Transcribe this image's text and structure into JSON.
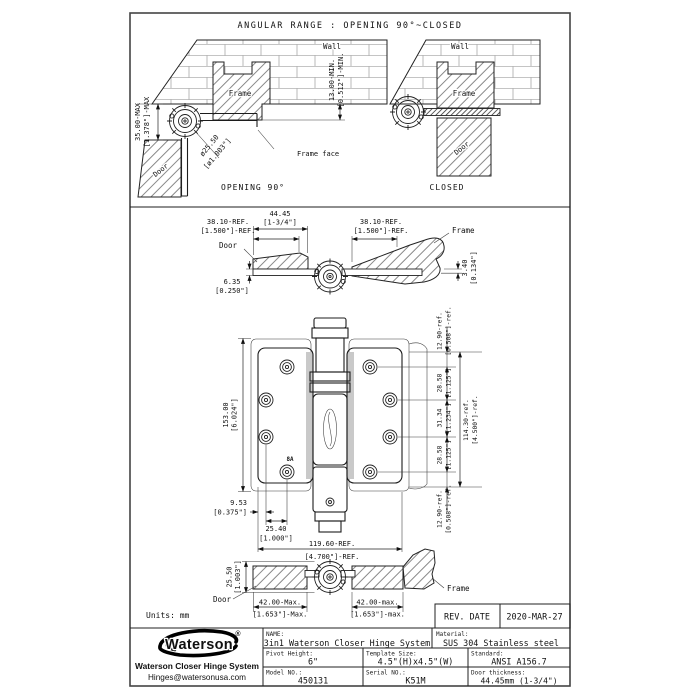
{
  "angular_panel": {
    "title": "ANGULAR RANGE : OPENING 90°~CLOSED",
    "open_view": {
      "wall": "Wall",
      "frame": "Frame",
      "door": "Door",
      "frame_face": "Frame face",
      "caption": "OPENING 90°",
      "dim_offset_max_mm": "35.00-MAX",
      "dim_offset_max_in": "[1.378\"]-MAX",
      "dim_barrel_dia_mm": "ø25.50",
      "dim_barrel_dia_in": "[ø1.003\"]",
      "dim_reveal_min_mm": "13.00-MIN.",
      "dim_reveal_min_in": "[0.512\"]-MIN."
    },
    "closed_view": {
      "wall": "Wall",
      "frame": "Frame",
      "door": "Door",
      "caption": "CLOSED"
    }
  },
  "plan_view": {
    "door": "Door",
    "frame": "Frame",
    "dim_door_thickness_mm": "44.45",
    "dim_door_thickness_in": "[1-3/4\"]",
    "dim_leaf_left_mm": "38.10-REF.",
    "dim_leaf_left_in": "[1.500\"]-REF.",
    "dim_leaf_right_mm": "38.10-REF.",
    "dim_leaf_right_in": "[1.500\"]-REF.",
    "dim_leaf_thk_mm": "6.35",
    "dim_leaf_thk_in": "[0.250\"]",
    "dim_stop_mm": "3.40",
    "dim_stop_in": "[0.134\"]"
  },
  "front_view": {
    "dim_height_mm": "153.00",
    "dim_height_in": "[6.024\"]",
    "dim_top_ref_mm": "12.90-ref.",
    "dim_top_ref_in": "[0.508\"]-ref.",
    "dim_row1_mm": "28.58",
    "dim_row1_in": "[1.125\"]",
    "dim_row2_mm": "31.34",
    "dim_row2_in": "[1.234\"]",
    "dim_row3_mm": "28.58",
    "dim_row3_in": "[1.125\"]",
    "dim_bot_ref_mm": "12.90-ref.",
    "dim_bot_ref_in": "[0.508\"]-ref.",
    "dim_span_mm": "114.30-ref.",
    "dim_span_in": "[4.500\"]-ref.",
    "dim_edge_mm": "9.53",
    "dim_edge_in": "[0.375\"]",
    "dim_col_mm": "25.40",
    "dim_col_in": "[1.000\"]",
    "dim_width_mm": "119.60-REF.",
    "dim_width_in": "[4.700\"]-REF.",
    "gauge_label": "8A"
  },
  "bottom_view": {
    "door": "Door",
    "frame": "Frame",
    "dim_knuckle_mm": "25.50",
    "dim_knuckle_in": "[1.003\"]",
    "dim_left_max_mm": "42.00-Max.",
    "dim_left_max_in": "[1.653\"]-Max.",
    "dim_right_max_mm": "42.00-max.",
    "dim_right_max_in": "[1.653\"]-max."
  },
  "footer": {
    "units": "Units: mm",
    "rev_label": "REV. DATE",
    "rev_date": "2020-MAR-27"
  },
  "title_block": {
    "logo_text": "Waterson",
    "logo_reg": "®",
    "company": "Waterson Closer Hinge System",
    "email": "Hinges@watersonusa.com",
    "name_label": "NAME:",
    "name_value": "3in1 Waterson Closer Hinge System",
    "material_label": "Material:",
    "material_value": "SUS 304 Stainless steel",
    "pivot_label": "Pivot Height:",
    "pivot_value": "6\"",
    "template_label": "Template Size:",
    "template_value": "4.5\"(H)x4.5\"(W)",
    "standard_label": "Standard:",
    "standard_value": "ANSI A156.7",
    "model_label": "Model NO.:",
    "model_value": "450131",
    "serial_label": "Serial NO.:",
    "serial_value": "K51M",
    "thickness_label": "Door thickness:",
    "thickness_value": "44.45mm (1-3/4\")"
  }
}
